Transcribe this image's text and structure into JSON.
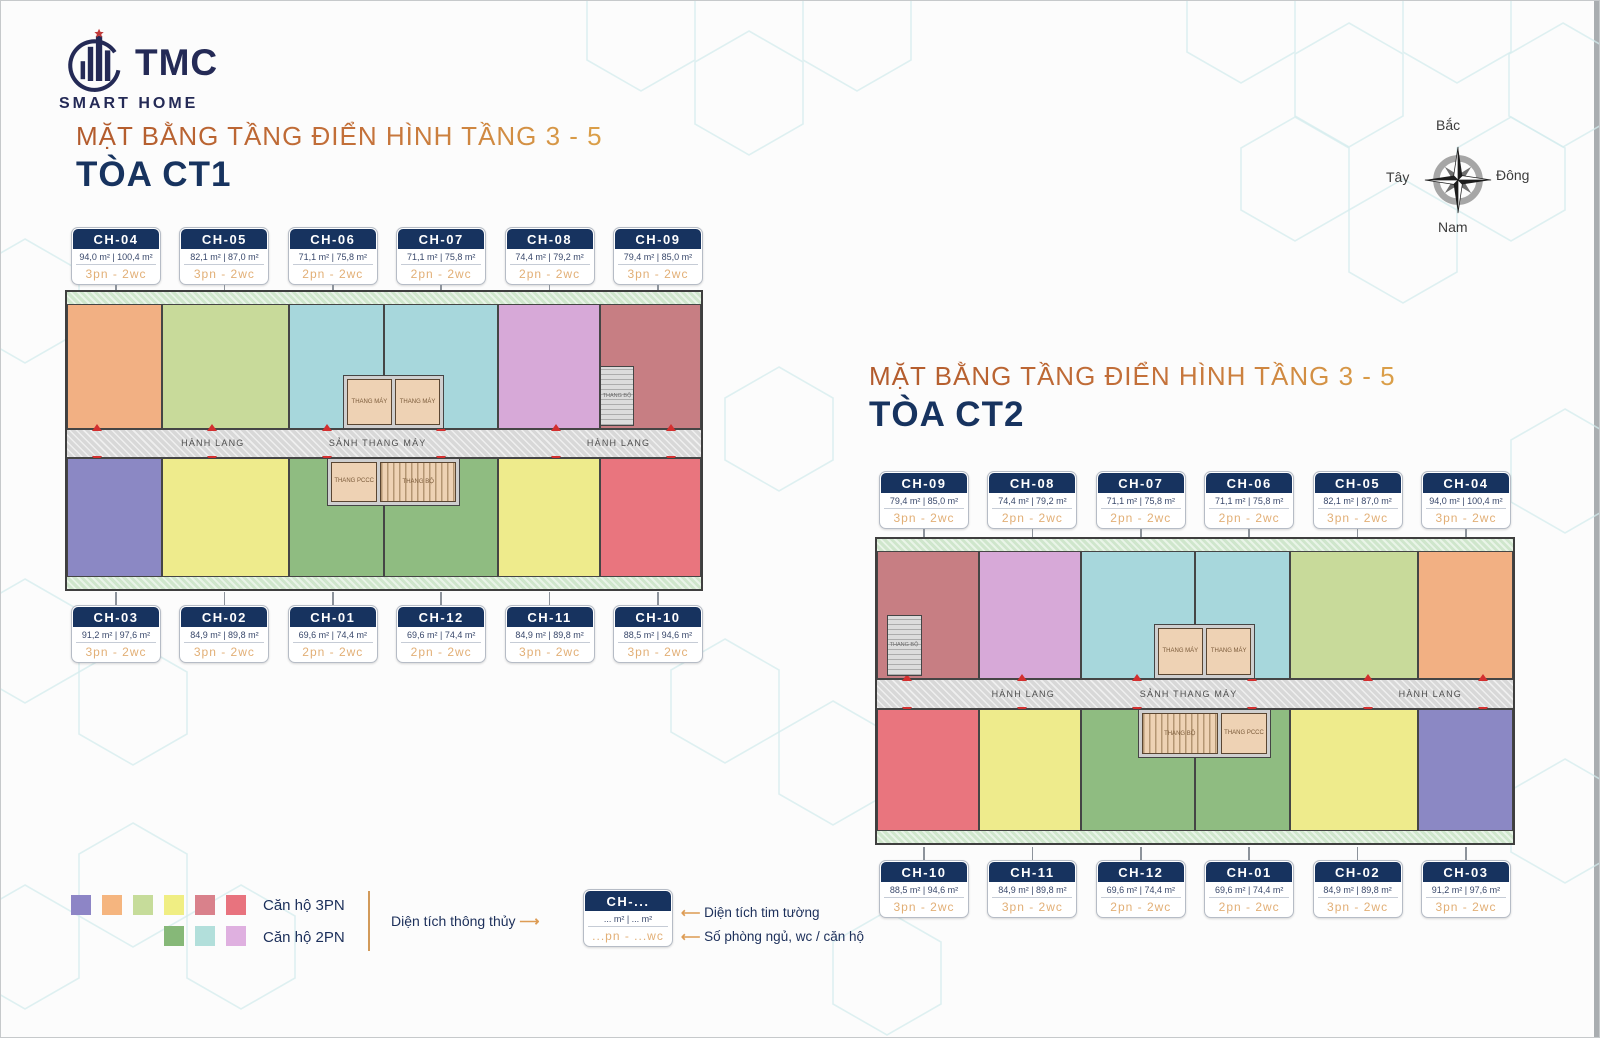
{
  "logo": {
    "brand": "TMC",
    "subtitle": "SMART HOME"
  },
  "compass": {
    "north": "Bắc",
    "east": "Đông",
    "south": "Nam",
    "west": "Tây"
  },
  "plan_labels": {
    "hallway": "HÀNH LANG",
    "lobby": "SẢNH THANG MÁY",
    "elevator": "THANG MÁY",
    "fire_stair": "THANG PCCC",
    "stair": "THANG BỘ"
  },
  "towers": [
    {
      "id": "ct1",
      "title": "MẶT BẰNG TẦNG ĐIỂN HÌNH TẦNG 3 - 5",
      "name": "TÒA CT1",
      "top_units": [
        {
          "code": "CH-04",
          "area": "94,0 m² | 100,4 m²",
          "rooms": "3pn - 2wc",
          "color": "#f2b083"
        },
        {
          "code": "CH-05",
          "area": "82,1 m² | 87,0 m²",
          "rooms": "3pn - 2wc",
          "color": "#c8da9a"
        },
        {
          "code": "CH-06",
          "area": "71,1 m² | 75,8 m²",
          "rooms": "2pn - 2wc",
          "color": "#a7d7dc"
        },
        {
          "code": "CH-07",
          "area": "71,1 m² | 75,8 m²",
          "rooms": "2pn - 2wc",
          "color": "#a7d7dc"
        },
        {
          "code": "CH-08",
          "area": "74,4 m² | 79,2 m²",
          "rooms": "2pn - 2wc",
          "color": "#d7a9d8"
        },
        {
          "code": "CH-09",
          "area": "79,4 m² | 85,0 m²",
          "rooms": "3pn - 2wc",
          "color": "#c77e83"
        }
      ],
      "bottom_units": [
        {
          "code": "CH-03",
          "area": "91,2 m² | 97,6 m²",
          "rooms": "3pn - 2wc",
          "color": "#8b88c4"
        },
        {
          "code": "CH-02",
          "area": "84,9 m² | 89,8 m²",
          "rooms": "3pn - 2wc",
          "color": "#eeeb8c"
        },
        {
          "code": "CH-01",
          "area": "69,6 m² | 74,4 m²",
          "rooms": "2pn - 2wc",
          "color": "#8fbc81"
        },
        {
          "code": "CH-12",
          "area": "69,6 m² | 74,4 m²",
          "rooms": "2pn - 2wc",
          "color": "#8fbc81"
        },
        {
          "code": "CH-11",
          "area": "84,9 m² | 89,8 m²",
          "rooms": "3pn - 2wc",
          "color": "#eeeb8c"
        },
        {
          "code": "CH-10",
          "area": "88,5 m² | 94,6 m²",
          "rooms": "3pn - 2wc",
          "color": "#e9757e"
        }
      ]
    },
    {
      "id": "ct2",
      "title": "MẶT BẰNG TẦNG ĐIỂN HÌNH TẦNG 3 - 5",
      "name": "TÒA CT2",
      "top_units": [
        {
          "code": "CH-09",
          "area": "79,4 m² | 85,0 m²",
          "rooms": "3pn - 2wc",
          "color": "#c77e83"
        },
        {
          "code": "CH-08",
          "area": "74,4 m² | 79,2 m²",
          "rooms": "2pn - 2wc",
          "color": "#d7a9d8"
        },
        {
          "code": "CH-07",
          "area": "71,1 m² | 75,8 m²",
          "rooms": "2pn - 2wc",
          "color": "#a7d7dc"
        },
        {
          "code": "CH-06",
          "area": "71,1 m² | 75,8 m²",
          "rooms": "2pn - 2wc",
          "color": "#a7d7dc"
        },
        {
          "code": "CH-05",
          "area": "82,1 m² | 87,0 m²",
          "rooms": "3pn - 2wc",
          "color": "#c8da9a"
        },
        {
          "code": "CH-04",
          "area": "94,0 m² | 100,4 m²",
          "rooms": "3pn - 2wc",
          "color": "#f2b083"
        }
      ],
      "bottom_units": [
        {
          "code": "CH-10",
          "area": "88,5 m² | 94,6 m²",
          "rooms": "3pn - 2wc",
          "color": "#e9757e"
        },
        {
          "code": "CH-11",
          "area": "84,9 m² | 89,8 m²",
          "rooms": "3pn - 2wc",
          "color": "#eeeb8c"
        },
        {
          "code": "CH-12",
          "area": "69,6 m² | 74,4 m²",
          "rooms": "2pn - 2wc",
          "color": "#8fbc81"
        },
        {
          "code": "CH-01",
          "area": "69,6 m² | 74,4 m²",
          "rooms": "2pn - 2wc",
          "color": "#8fbc81"
        },
        {
          "code": "CH-02",
          "area": "84,9 m² | 89,8 m²",
          "rooms": "3pn - 2wc",
          "color": "#eeeb8c"
        },
        {
          "code": "CH-03",
          "area": "91,2 m² | 97,6 m²",
          "rooms": "3pn - 2wc",
          "color": "#8b88c4"
        }
      ]
    }
  ],
  "legend": {
    "groups": [
      {
        "label": "Căn hộ 3PN",
        "colors": [
          "#8d85c6",
          "#f5b57f",
          "#c6dc9a",
          "#f0ee83",
          "#d9818b",
          "#e8737e"
        ]
      },
      {
        "label": "Căn hộ 2PN",
        "colors": [
          "#86b878",
          "#b2dfdb",
          "#dfb0e0"
        ]
      }
    ],
    "clear_area_label": "Diện tích thông thủy",
    "gross_area_label": "Diện tích tim tường",
    "rooms_label": "Số phòng ngủ, wc / căn hộ",
    "arrow_right": "⟶",
    "arrow_left": "⟵",
    "sample": {
      "code": "CH-...",
      "area": "... m² | ... m²",
      "rooms": "...pn - ...wc"
    }
  }
}
